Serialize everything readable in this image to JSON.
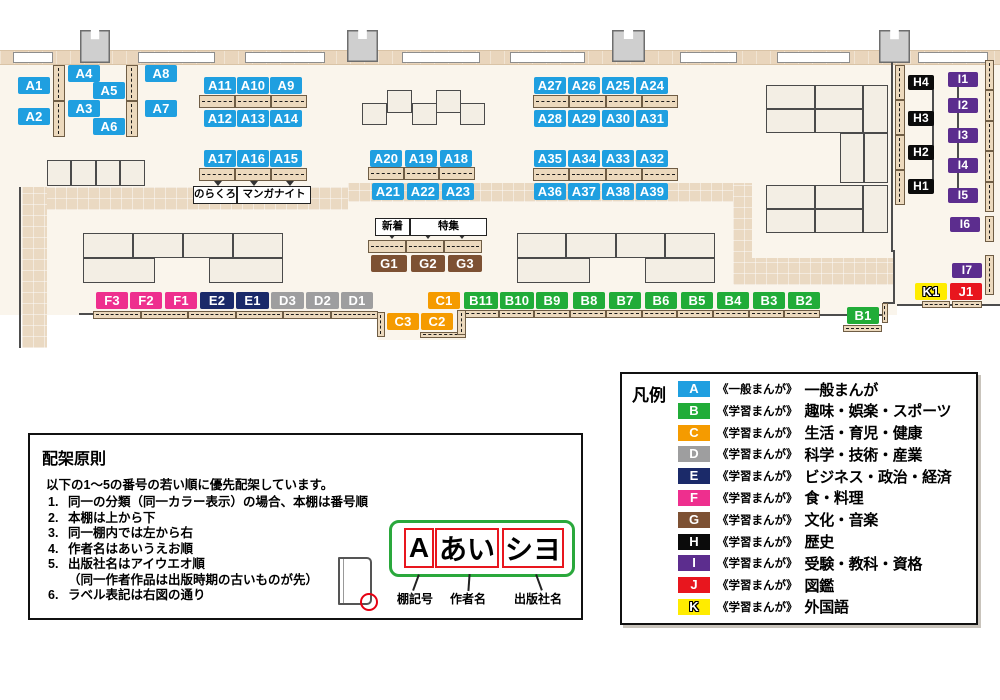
{
  "colors": {
    "A": "#1f9fe0",
    "B": "#21ac38",
    "C": "#f59b00",
    "D": "#9e9e9f",
    "E": "#1b2a69",
    "F": "#ee2f8e",
    "G": "#7d5133",
    "H": "#0b0b0b",
    "I": "#5c2d8e",
    "J": "#e8161e",
    "K": "#ffec00"
  },
  "map": {
    "shelf_labels": [
      {
        "id": "A1",
        "cat": "A",
        "x": 18,
        "y": 77
      },
      {
        "id": "A2",
        "cat": "A",
        "x": 18,
        "y": 108
      },
      {
        "id": "A4",
        "cat": "A",
        "x": 68,
        "y": 65
      },
      {
        "id": "A3",
        "cat": "A",
        "x": 68,
        "y": 100
      },
      {
        "id": "A5",
        "cat": "A",
        "x": 93,
        "y": 82
      },
      {
        "id": "A6",
        "cat": "A",
        "x": 93,
        "y": 118
      },
      {
        "id": "A8",
        "cat": "A",
        "x": 145,
        "y": 65
      },
      {
        "id": "A7",
        "cat": "A",
        "x": 145,
        "y": 100
      },
      {
        "id": "A11",
        "cat": "A",
        "x": 204,
        "y": 77
      },
      {
        "id": "A10",
        "cat": "A",
        "x": 237,
        "y": 77
      },
      {
        "id": "A9",
        "cat": "A",
        "x": 270,
        "y": 77
      },
      {
        "id": "A12",
        "cat": "A",
        "x": 204,
        "y": 110
      },
      {
        "id": "A13",
        "cat": "A",
        "x": 237,
        "y": 110
      },
      {
        "id": "A14",
        "cat": "A",
        "x": 270,
        "y": 110
      },
      {
        "id": "A17",
        "cat": "A",
        "x": 204,
        "y": 150
      },
      {
        "id": "A16",
        "cat": "A",
        "x": 237,
        "y": 150
      },
      {
        "id": "A15",
        "cat": "A",
        "x": 270,
        "y": 150
      },
      {
        "id": "A20",
        "cat": "A",
        "x": 370,
        "y": 150
      },
      {
        "id": "A19",
        "cat": "A",
        "x": 405,
        "y": 150
      },
      {
        "id": "A18",
        "cat": "A",
        "x": 440,
        "y": 150
      },
      {
        "id": "A21",
        "cat": "A",
        "x": 372,
        "y": 183
      },
      {
        "id": "A22",
        "cat": "A",
        "x": 407,
        "y": 183
      },
      {
        "id": "A23",
        "cat": "A",
        "x": 442,
        "y": 183
      },
      {
        "id": "A27",
        "cat": "A",
        "x": 534,
        "y": 77
      },
      {
        "id": "A26",
        "cat": "A",
        "x": 568,
        "y": 77
      },
      {
        "id": "A25",
        "cat": "A",
        "x": 602,
        "y": 77
      },
      {
        "id": "A24",
        "cat": "A",
        "x": 636,
        "y": 77
      },
      {
        "id": "A28",
        "cat": "A",
        "x": 534,
        "y": 110
      },
      {
        "id": "A29",
        "cat": "A",
        "x": 568,
        "y": 110
      },
      {
        "id": "A30",
        "cat": "A",
        "x": 602,
        "y": 110
      },
      {
        "id": "A31",
        "cat": "A",
        "x": 636,
        "y": 110
      },
      {
        "id": "A35",
        "cat": "A",
        "x": 534,
        "y": 150
      },
      {
        "id": "A34",
        "cat": "A",
        "x": 568,
        "y": 150
      },
      {
        "id": "A33",
        "cat": "A",
        "x": 602,
        "y": 150
      },
      {
        "id": "A32",
        "cat": "A",
        "x": 636,
        "y": 150
      },
      {
        "id": "A36",
        "cat": "A",
        "x": 534,
        "y": 183
      },
      {
        "id": "A37",
        "cat": "A",
        "x": 568,
        "y": 183
      },
      {
        "id": "A38",
        "cat": "A",
        "x": 602,
        "y": 183
      },
      {
        "id": "A39",
        "cat": "A",
        "x": 636,
        "y": 183
      },
      {
        "id": "G1",
        "cat": "G",
        "x": 371,
        "y": 255,
        "w": 36
      },
      {
        "id": "G2",
        "cat": "G",
        "x": 411,
        "y": 255,
        "w": 34
      },
      {
        "id": "G3",
        "cat": "G",
        "x": 448,
        "y": 255,
        "w": 34
      },
      {
        "id": "F3",
        "cat": "F",
        "x": 96,
        "y": 292
      },
      {
        "id": "F2",
        "cat": "F",
        "x": 130,
        "y": 292
      },
      {
        "id": "F1",
        "cat": "F",
        "x": 165,
        "y": 292
      },
      {
        "id": "E2",
        "cat": "E",
        "x": 200,
        "y": 292,
        "w": 34
      },
      {
        "id": "E1",
        "cat": "E",
        "x": 236,
        "y": 292,
        "w": 33
      },
      {
        "id": "D3",
        "cat": "D",
        "x": 271,
        "y": 292,
        "w": 33
      },
      {
        "id": "D2",
        "cat": "D",
        "x": 306,
        "y": 292,
        "w": 33
      },
      {
        "id": "D1",
        "cat": "D",
        "x": 341,
        "y": 292
      },
      {
        "id": "C1",
        "cat": "C",
        "x": 428,
        "y": 292
      },
      {
        "id": "C3",
        "cat": "C",
        "x": 387,
        "y": 313
      },
      {
        "id": "C2",
        "cat": "C",
        "x": 421,
        "y": 313
      },
      {
        "id": "B11",
        "cat": "B",
        "x": 464,
        "y": 292,
        "w": 34
      },
      {
        "id": "B10",
        "cat": "B",
        "x": 500,
        "y": 292,
        "w": 34
      },
      {
        "id": "B9",
        "cat": "B",
        "x": 536,
        "y": 292
      },
      {
        "id": "B8",
        "cat": "B",
        "x": 573,
        "y": 292
      },
      {
        "id": "B7",
        "cat": "B",
        "x": 609,
        "y": 292
      },
      {
        "id": "B6",
        "cat": "B",
        "x": 645,
        "y": 292
      },
      {
        "id": "B5",
        "cat": "B",
        "x": 681,
        "y": 292
      },
      {
        "id": "B4",
        "cat": "B",
        "x": 717,
        "y": 292
      },
      {
        "id": "B3",
        "cat": "B",
        "x": 753,
        "y": 292
      },
      {
        "id": "B2",
        "cat": "B",
        "x": 788,
        "y": 292
      },
      {
        "id": "B1",
        "cat": "B",
        "x": 847,
        "y": 307
      },
      {
        "id": "H4",
        "cat": "H",
        "x": 908,
        "y": 75,
        "w": 26,
        "small": true
      },
      {
        "id": "H3",
        "cat": "H",
        "x": 908,
        "y": 111,
        "w": 26,
        "small": true
      },
      {
        "id": "H2",
        "cat": "H",
        "x": 908,
        "y": 145,
        "w": 26,
        "small": true
      },
      {
        "id": "H1",
        "cat": "H",
        "x": 908,
        "y": 179,
        "w": 26,
        "small": true
      },
      {
        "id": "I1",
        "cat": "I",
        "x": 948,
        "y": 72,
        "w": 30,
        "small": true
      },
      {
        "id": "I2",
        "cat": "I",
        "x": 948,
        "y": 98,
        "w": 30,
        "small": true
      },
      {
        "id": "I3",
        "cat": "I",
        "x": 948,
        "y": 128,
        "w": 30,
        "small": true
      },
      {
        "id": "I4",
        "cat": "I",
        "x": 948,
        "y": 158,
        "w": 30,
        "small": true
      },
      {
        "id": "I5",
        "cat": "I",
        "x": 948,
        "y": 188,
        "w": 30,
        "small": true
      },
      {
        "id": "I6",
        "cat": "I",
        "x": 950,
        "y": 217,
        "w": 30,
        "small": true
      },
      {
        "id": "I7",
        "cat": "I",
        "x": 952,
        "y": 263,
        "w": 30,
        "small": true
      },
      {
        "id": "K1",
        "cat": "K",
        "x": 915,
        "y": 283,
        "w": 32
      },
      {
        "id": "J1",
        "cat": "J",
        "x": 950,
        "y": 283,
        "w": 32
      }
    ],
    "annotations": [
      {
        "text": "のらくろ",
        "x": 193,
        "y": 186,
        "w": 42
      },
      {
        "text": "マンガナイト",
        "x": 237,
        "y": 186,
        "w": 72
      },
      {
        "text": "新着",
        "x": 375,
        "y": 218,
        "w": 33
      },
      {
        "text": "特集",
        "x": 410,
        "y": 218,
        "w": 75
      }
    ]
  },
  "legend": {
    "title": "凡例",
    "items": [
      {
        "code": "A",
        "type": "《一般まんが》",
        "category": "一般まんが"
      },
      {
        "code": "B",
        "type": "《学習まんが》",
        "category": "趣味・娯楽・スポーツ"
      },
      {
        "code": "C",
        "type": "《学習まんが》",
        "category": "生活・育児・健康"
      },
      {
        "code": "D",
        "type": "《学習まんが》",
        "category": "科学・技術・産業"
      },
      {
        "code": "E",
        "type": "《学習まんが》",
        "category": "ビジネス・政治・経済"
      },
      {
        "code": "F",
        "type": "《学習まんが》",
        "category": "食・料理"
      },
      {
        "code": "G",
        "type": "《学習まんが》",
        "category": "文化・音楽"
      },
      {
        "code": "H",
        "type": "《学習まんが》",
        "category": "歴史"
      },
      {
        "code": "I",
        "type": "《学習まんが》",
        "category": "受験・教科・資格"
      },
      {
        "code": "J",
        "type": "《学習まんが》",
        "category": "図鑑"
      },
      {
        "code": "K",
        "type": "《学習まんが》",
        "category": "外国語"
      }
    ]
  },
  "principles": {
    "title": "配架原則",
    "intro": "以下の1～5の番号の若い順に優先配架しています。",
    "rules": [
      "同一の分類（同一カラー表示）の場合、本棚は番号順",
      "本棚は上から下",
      "同一棚内では左から右",
      "作者名はあいうえお順",
      "出版社名はアイウエオ順",
      "ラベル表記は右図の通り"
    ],
    "note": "（同一作者作品は出版時期の古いものが先）",
    "label_example": {
      "frame_items": [
        {
          "text": "A",
          "caption": "棚記号"
        },
        {
          "text": "あい",
          "caption": "作者名"
        },
        {
          "text": "シヨ",
          "caption": "出版社名"
        }
      ]
    }
  }
}
